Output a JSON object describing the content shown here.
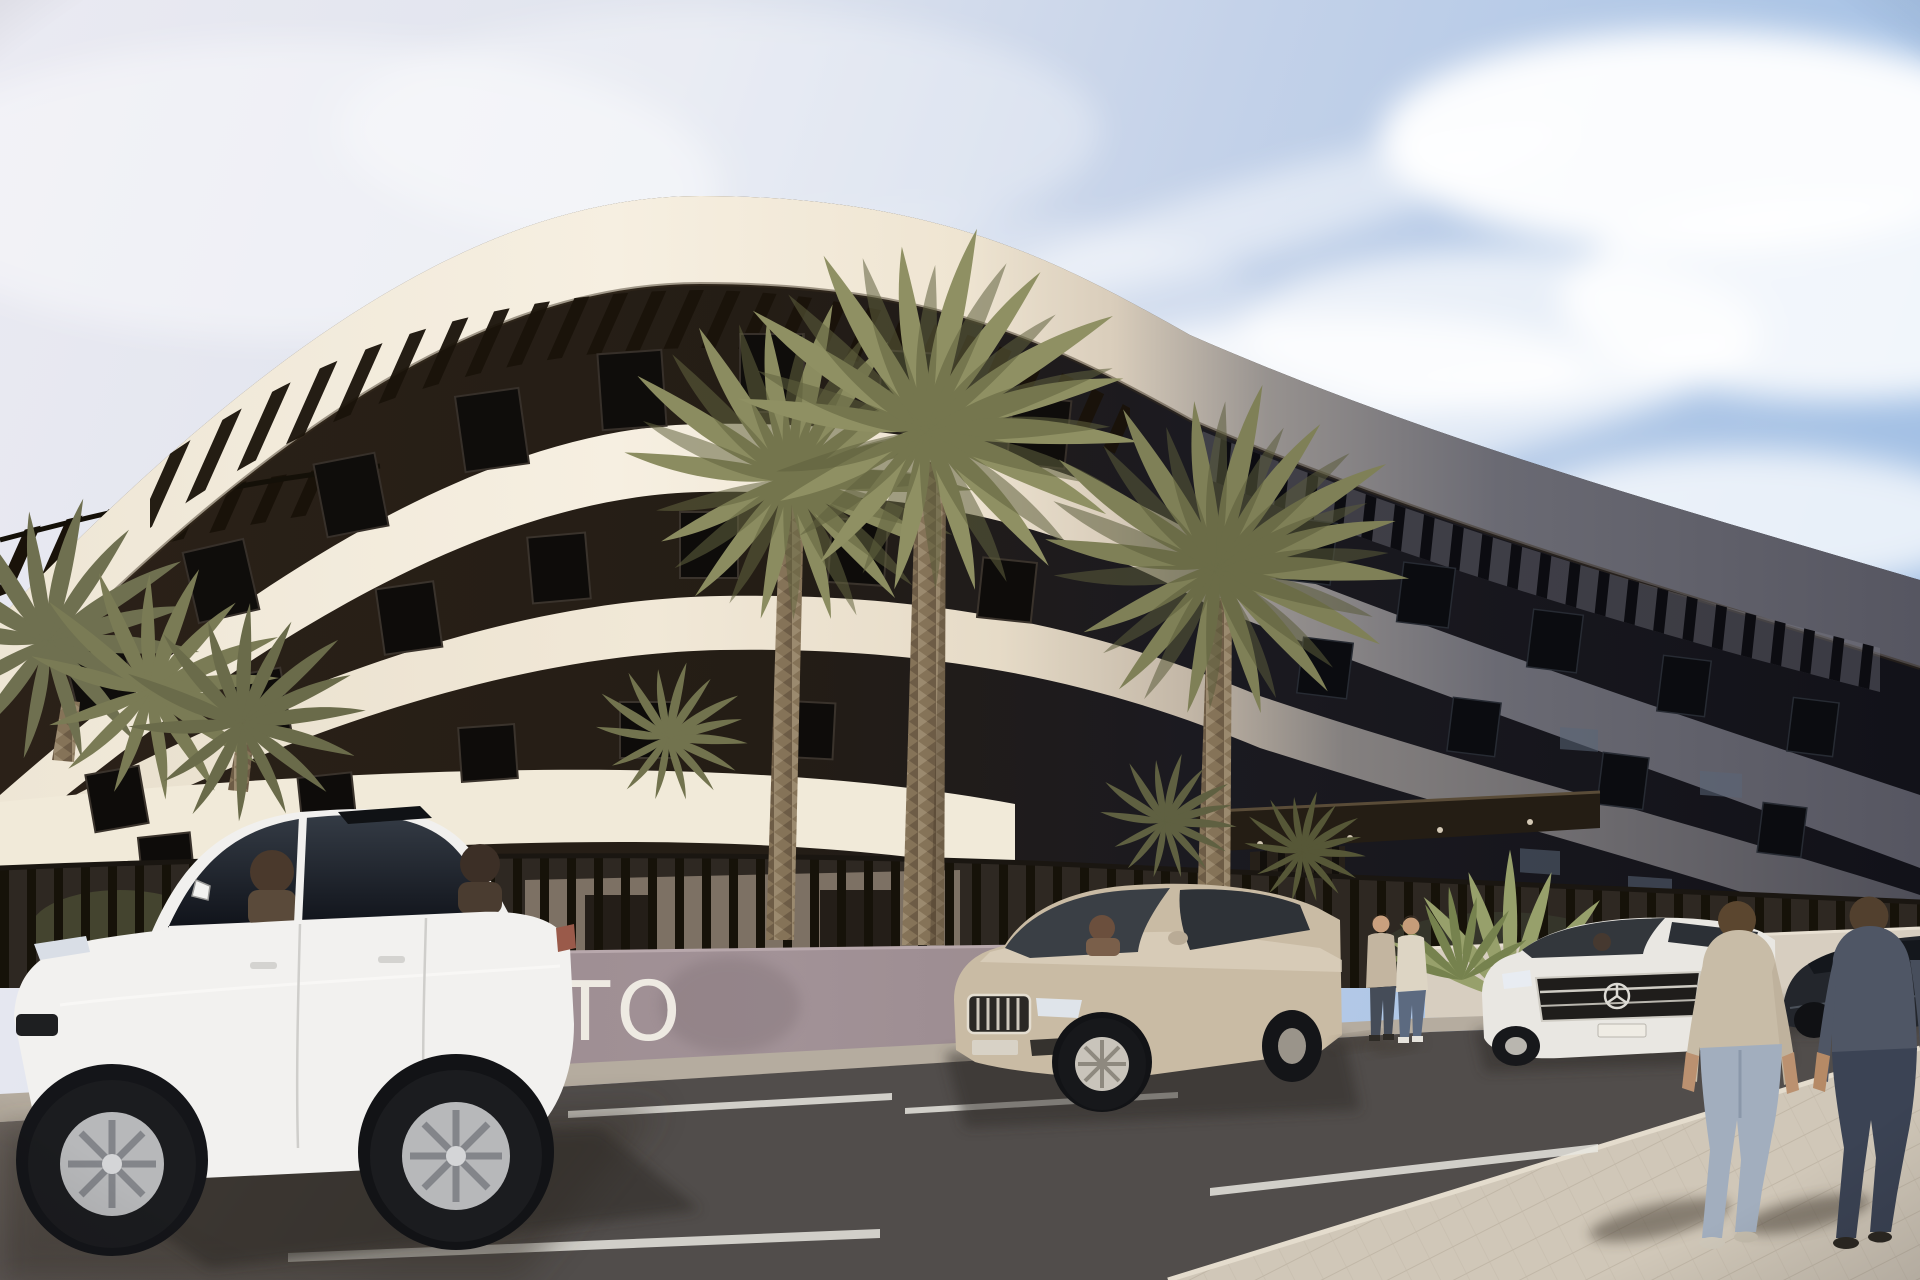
{
  "scene": {
    "type": "architectural-exterior-render",
    "setting": "Modern curved low-rise apartment building with rooftop pergola slats, palm trees, street parking and pedestrians in bright daylight",
    "sign": {
      "wall_text": "TO",
      "wall_color": "#9a8a8f",
      "text_color": "#f3efe7"
    },
    "sky": {
      "left_color": "#e9e9f1",
      "right_color": "#a4c1e5",
      "clouds": "wispy cirrus, denser toward top right"
    },
    "building": {
      "storeys_visible": 3,
      "band_color_sunlit": "#f2ebdc",
      "band_color_shadow": "#5a5a64",
      "recess_color": "#221b14",
      "features": [
        "curved white floor bands",
        "rooftop pergola slats",
        "recessed dark balconies",
        "dark entrance canopy",
        "vertical slat perimeter fence"
      ]
    },
    "vegetation": {
      "tall_palms": 3,
      "palm_clusters": 2,
      "agave_plants": 1,
      "palm_color": "#8a8b5e"
    },
    "vehicles": [
      {
        "kind": "sedan",
        "color_name": "white",
        "color": "#f1f0ee",
        "position": "foreground left",
        "occupants": 2
      },
      {
        "kind": "suv",
        "color_name": "champagne",
        "color": "#c9bba4",
        "position": "center, facing left",
        "occupants": 1
      },
      {
        "kind": "sedan",
        "color_name": "white",
        "color": "#e9e7e2",
        "position": "right of entrance, three-pointed-star grille"
      },
      {
        "kind": "sedan",
        "color_name": "dark gray",
        "color": "#23262c",
        "position": "far right edge"
      }
    ],
    "people": [
      {
        "pose": "standing pair",
        "position": "near entrance gate",
        "clothing": "beige jacket and cream sweater with jeans"
      },
      {
        "pose": "walking away",
        "position": "foreground right",
        "clothing": "tan t-shirt, light jeans"
      },
      {
        "pose": "walking away",
        "position": "foreground far right",
        "clothing": "dark gray t-shirt, dark jeans"
      }
    ],
    "ground": {
      "road_color": "#6b6460",
      "sidewalk_color": "#cfc6b7",
      "marking_color": "#e8e6df",
      "markings": "white parking bay lines"
    }
  }
}
